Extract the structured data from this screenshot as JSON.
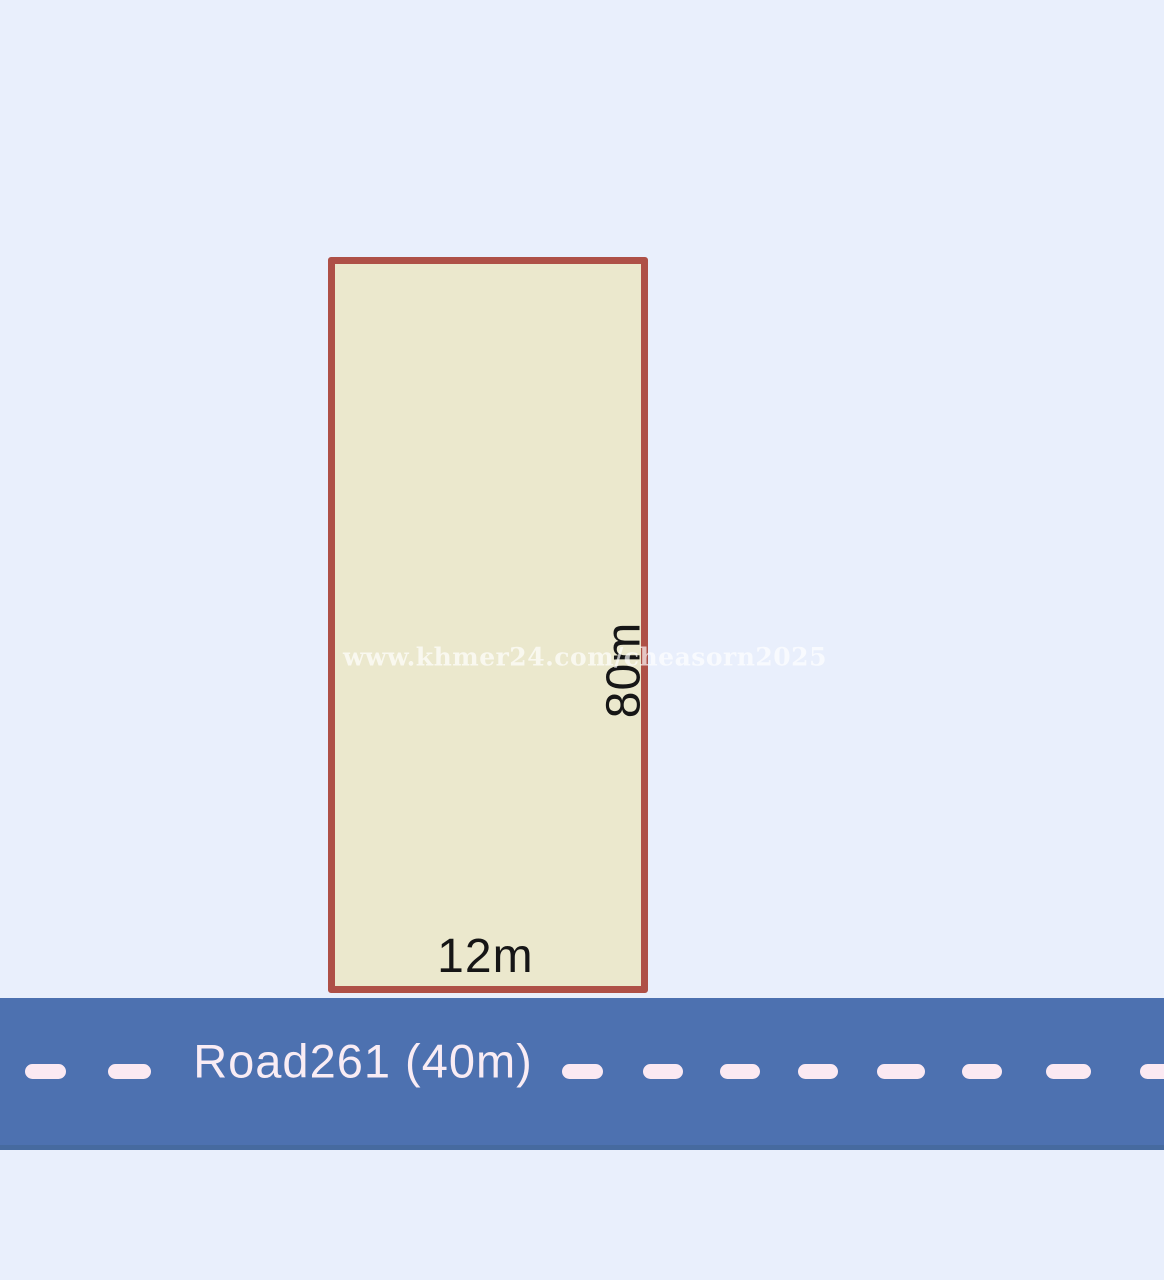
{
  "diagram": {
    "background_color": "#e9effc",
    "watermark": {
      "text": "www.khmer24.com/cheasorn2025"
    },
    "plot": {
      "frontage_label": "12m",
      "depth_label": "80m",
      "fill_color": "#ebe8cd",
      "border_color": "#ae5047",
      "label_color": "#161616"
    },
    "road": {
      "label": "Road261 (40m)",
      "surface_color": "#4d71b0",
      "marking_color": "#fbe9f2",
      "label_color": "#f9ecf4",
      "lane_marking_count": 10
    }
  }
}
